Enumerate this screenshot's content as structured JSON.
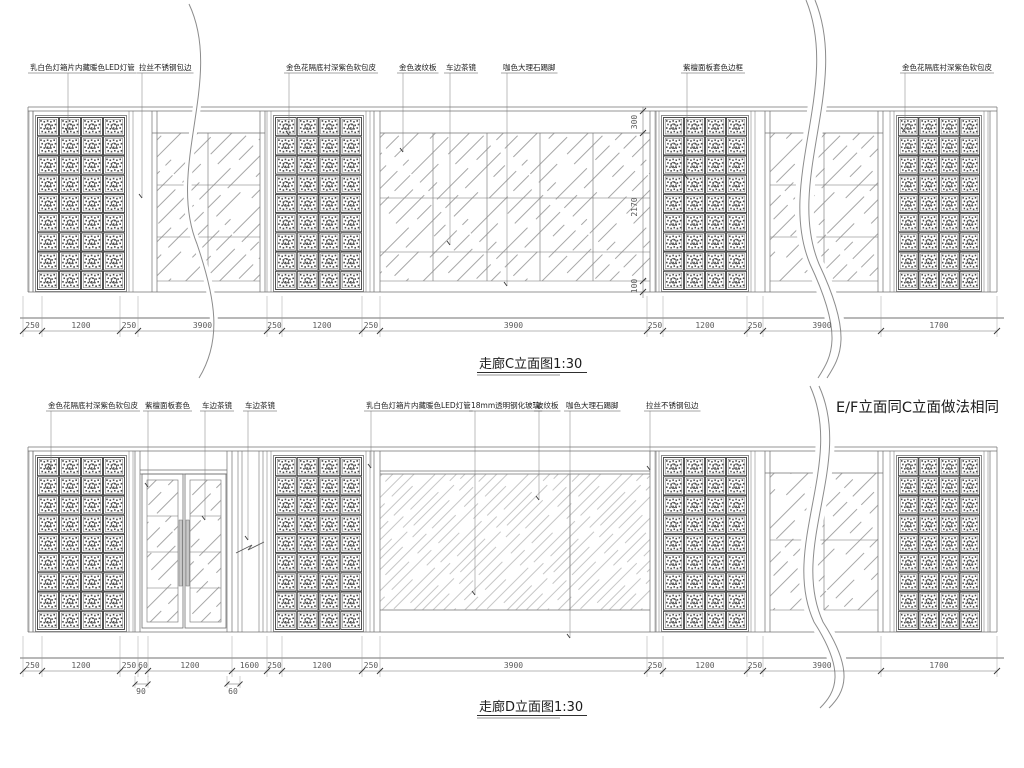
{
  "colors": {
    "background": "#ffffff",
    "line": "#707070",
    "ink": "#2f2f2f",
    "hatch": "#8a8a8a"
  },
  "titles": {
    "c": "走廊C立面图1:30",
    "d": "走廊D立面图1:30",
    "note": "E/F立面同C立面做法相同"
  },
  "elevation_c": {
    "callouts": [
      {
        "text": "乳白色灯箱片内藏暖色LED灯管",
        "x": 30,
        "lx": 68,
        "ty": 132
      },
      {
        "text": "拉丝不锈钢包边",
        "x": 139,
        "lx": 142,
        "ty": 198
      },
      {
        "text": "金色花隔底衬深紫色软包皮",
        "x": 286,
        "lx": 289,
        "ty": 135
      },
      {
        "text": "金色波纹板",
        "x": 399,
        "lx": 403,
        "ty": 152
      },
      {
        "text": "车边茶镜",
        "x": 446,
        "lx": 450,
        "ty": 245
      },
      {
        "text": "咖色大理石踢脚",
        "x": 503,
        "lx": 507,
        "ty": 286
      },
      {
        "text": "紫檀面板套色边框",
        "x": 683,
        "lx": 687,
        "ty": 178
      },
      {
        "text": "金色花隔底衬深紫色软包皮",
        "x": 902,
        "lx": 905,
        "ty": 132
      }
    ],
    "dims": {
      "boundaries": [
        23,
        42,
        120,
        138,
        267,
        282,
        362,
        380,
        647,
        663,
        747,
        763,
        881,
        997
      ],
      "labels": [
        "250",
        "1200",
        "250",
        "3900",
        "250",
        "1200",
        "250",
        "3900",
        "250",
        "1200",
        "250",
        "3900",
        "1700"
      ]
    },
    "vdims": [
      {
        "label": "300",
        "y": 122
      },
      {
        "label": "2170",
        "y": 207
      },
      {
        "label": "100",
        "y": 286
      }
    ]
  },
  "elevation_d": {
    "callouts": [
      {
        "text": "金色花隔底衬深紫色软包皮",
        "x": 48,
        "lx": 51,
        "ty": 470
      },
      {
        "text": "紫檀面板套色",
        "x": 145,
        "lx": 148,
        "ty": 487
      },
      {
        "text": "车边茶镜",
        "x": 202,
        "lx": 205,
        "ty": 520
      },
      {
        "text": "车边茶镜",
        "x": 245,
        "lx": 248,
        "ty": 540
      },
      {
        "text": "乳白色灯箱片内藏暖色LED灯管",
        "x": 366,
        "lx": 371,
        "ty": 468
      },
      {
        "text": "18mm透明钢化玻璃",
        "x": 471,
        "lx": 475,
        "ty": 595
      },
      {
        "text": "波纹板",
        "x": 536,
        "lx": 539,
        "ty": 500
      },
      {
        "text": "咖色大理石踢脚",
        "x": 566,
        "lx": 570,
        "ty": 638
      },
      {
        "text": "拉丝不锈钢包边",
        "x": 646,
        "lx": 650,
        "ty": 470
      }
    ],
    "dims": {
      "boundaries": [
        23,
        42,
        120,
        138,
        148,
        232,
        267,
        282,
        362,
        380,
        647,
        663,
        747,
        763,
        881,
        997
      ],
      "labels": [
        "250",
        "1200",
        "250",
        "60",
        "1200",
        "1600",
        "250",
        "1200",
        "250",
        "3900",
        "250",
        "1200",
        "250",
        "3900",
        "1700"
      ]
    },
    "sub_dims": [
      {
        "label": "90",
        "x": 141
      },
      {
        "label": "60",
        "x": 233
      }
    ]
  }
}
